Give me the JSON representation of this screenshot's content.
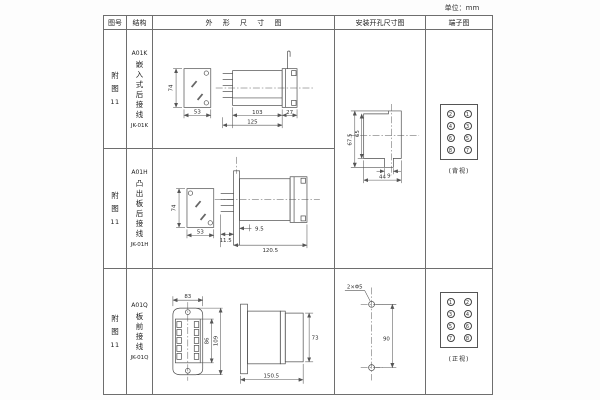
{
  "unit_label": "单位：mm",
  "header": {
    "fig_no": "图号",
    "structure": "结构",
    "outline": "外 形 尺 寸 图",
    "mounting": "安装开孔尺寸图",
    "terminal": "端子图"
  },
  "rows": [
    {
      "fig": [
        "附",
        "图",
        "11"
      ],
      "model": "A01K",
      "structure_text": "嵌入式后接线",
      "code": "JK-01K",
      "dims": {
        "front_h": "74",
        "front_w": "53",
        "body_len": "103",
        "flange_len": "27",
        "total_len": "125"
      }
    },
    {
      "fig": [
        "附",
        "图",
        "11"
      ],
      "model": "A01H",
      "structure_text": "凸出板后接线",
      "code": "JK-01H",
      "dims": {
        "front_h": "74",
        "front_w": "53",
        "stud_len": "9.5",
        "plate_offset": "11.5",
        "total_len": "120.5"
      }
    },
    {
      "fig": [
        "附",
        "图",
        "11"
      ],
      "model": "A01Q",
      "structure_text": "板前接线",
      "code": "JK-01Q",
      "dims": {
        "front_w": "83",
        "terminal_h": "86",
        "front_h": "109",
        "side_h": "73",
        "total_len": "150.5"
      }
    }
  ],
  "mounting_top": {
    "outer_h": "67.5",
    "inner_h": "65",
    "notch_w": "9",
    "total_w": "44"
  },
  "mounting_bottom": {
    "holes_label": "2×Φ5",
    "hole_spacing": "90"
  },
  "terminal_top": {
    "numbers": [
      [
        "2",
        "1"
      ],
      [
        "4",
        "3"
      ],
      [
        "6",
        "5"
      ],
      [
        "8",
        "7"
      ]
    ],
    "view_label": "(背视)"
  },
  "terminal_bottom": {
    "numbers": [
      [
        "1",
        "2"
      ],
      [
        "3",
        "4"
      ],
      [
        "5",
        "6"
      ],
      [
        "7",
        "8"
      ]
    ],
    "view_label": "(正视)"
  }
}
